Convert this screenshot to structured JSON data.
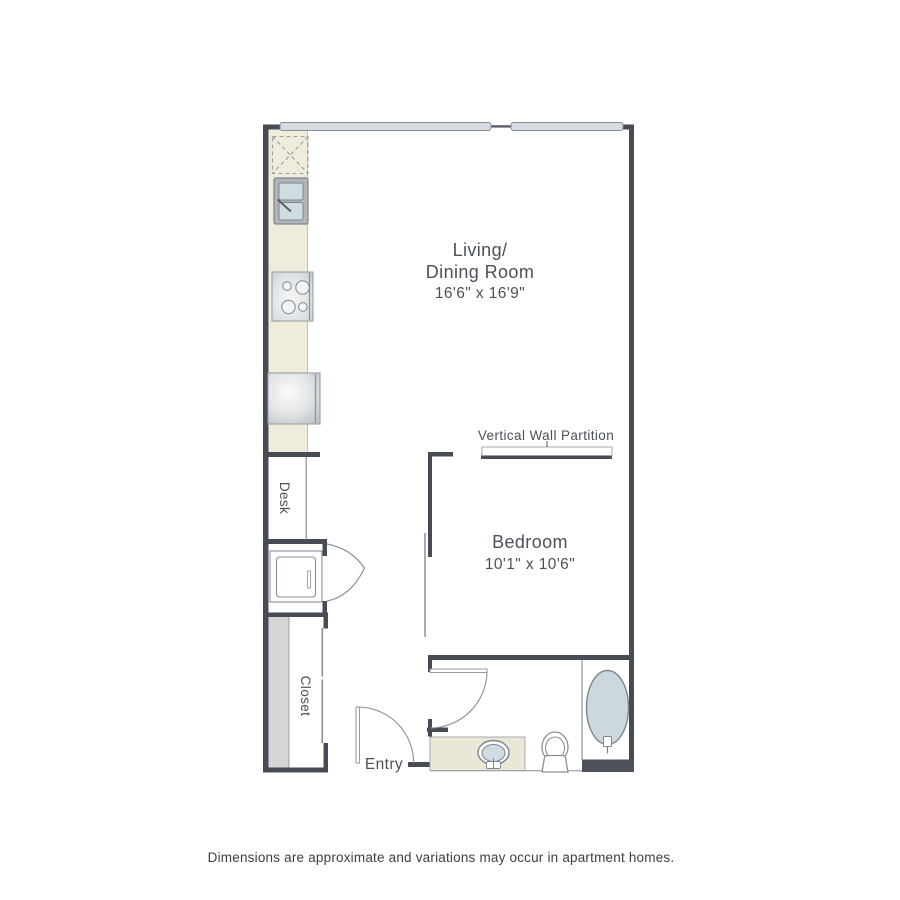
{
  "floor_plan": {
    "rooms": {
      "living_dining": {
        "name_line1": "Living/",
        "name_line2": "Dining Room",
        "dimensions": "16'6\" x 16'9\""
      },
      "bedroom": {
        "name": "Bedroom",
        "dimensions": "10'1\" x 10'6\""
      }
    },
    "labels": {
      "partition": "Vertical Wall Partition",
      "desk": "Desk",
      "closet": "Closet",
      "entry": "Entry"
    },
    "fixtures": [
      "refrigerator-space",
      "kitchen-double-sink",
      "stove-cooktop",
      "washer-dryer",
      "utility-closet-appliance",
      "closet-bifold-door",
      "closet-sliding-doors",
      "entry-door",
      "bathroom-door",
      "bathroom-vanity-sink",
      "toilet",
      "bathtub",
      "window-band-left",
      "window-band-right",
      "vertical-wall-partition"
    ],
    "colors": {
      "wall": "#474c54",
      "counter_cream": "#f0ecdb",
      "vanity_cream": "#ebe7d6",
      "fixture_blue": "#cfdde2",
      "window_gray": "#d5dbe0",
      "closet_band_gray": "#d6d6d6",
      "threshold_dark": "#4c515a",
      "label_text": "#4b5157"
    }
  },
  "footer": {
    "disclaimer": "Dimensions are approximate and variations may occur in apartment homes."
  }
}
